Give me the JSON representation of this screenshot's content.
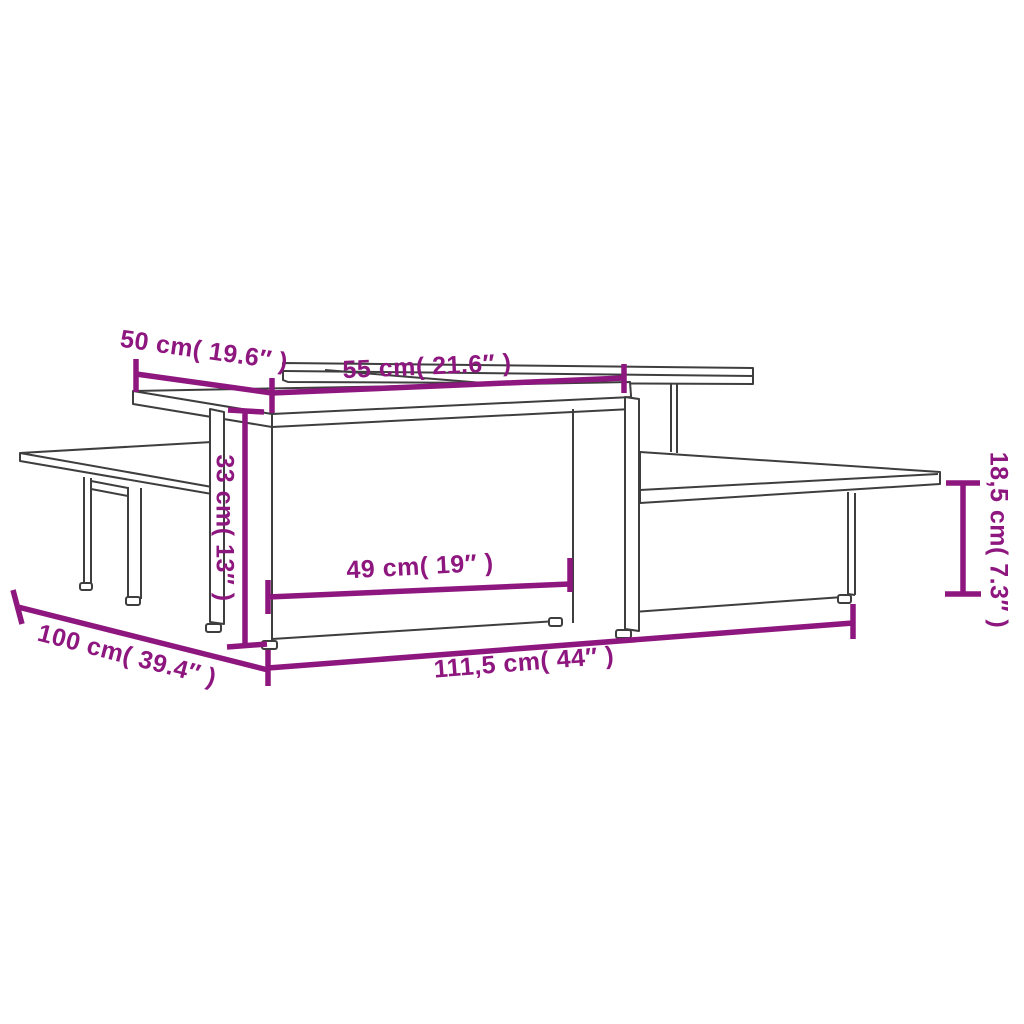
{
  "diagram": {
    "kind": "furniture-dimension-drawing",
    "dimension_labels": {
      "top_depth_50": "50 cm( 19.6″ )",
      "top_width_55": "55 cm( 21.6″ )",
      "tall_height_33": "33 cm( 13″ )",
      "opening_width_49": "49 cm( 19″ )",
      "low_height_18_5": "18,5 cm( 7.3″ )",
      "overall_depth_100": "100 cm( 39.4″ )",
      "overall_width_111_5": "111,5 cm( 44″ )"
    },
    "colors": {
      "dimension_accent": "#8E177F",
      "furniture_outline": "#3E3E3E",
      "background": "#FFFFFF"
    }
  }
}
